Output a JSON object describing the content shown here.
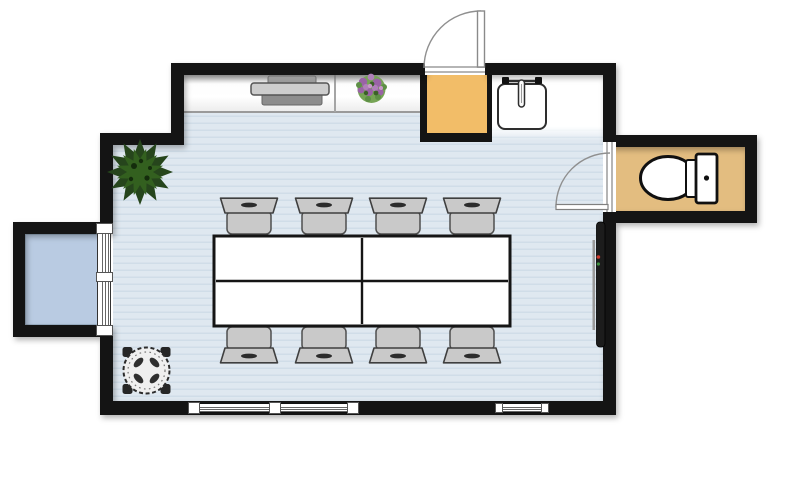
{
  "view": {
    "kind": "2d-floor-plan",
    "visible_text": [],
    "rooms": [
      {
        "name": "meeting-room",
        "floor_color": "#dfe8f0",
        "floor_pattern": "horizontal-stripes"
      },
      {
        "name": "balcony-bay",
        "floor_color": "#b9cbe2"
      },
      {
        "name": "closet",
        "floor_color": "#f2bd68"
      },
      {
        "name": "kitchenette-nook",
        "floor_color": "#ffffff"
      },
      {
        "name": "bathroom",
        "floor_color": "#e3bd80"
      }
    ],
    "furniture": [
      {
        "name": "conference-table",
        "count": 1,
        "segments": 4,
        "color": "#ffffff"
      },
      {
        "name": "chair",
        "count": 8,
        "arrangement": "4 top / 4 bottom",
        "color": "#c9c9c9"
      },
      {
        "name": "bistro-table",
        "count": 1,
        "shape": "round-dashed"
      },
      {
        "name": "large-plant",
        "count": 1,
        "color": "#26451c"
      },
      {
        "name": "flower-pot",
        "count": 1,
        "colors": [
          "#9a63a6",
          "#76a455"
        ]
      },
      {
        "name": "printer",
        "count": 1,
        "color": "#8d8d8d"
      },
      {
        "name": "wall-tv",
        "count": 1,
        "color": "#1c1c1c"
      },
      {
        "name": "sink",
        "count": 1
      },
      {
        "name": "toilet",
        "count": 1
      }
    ],
    "openings": [
      {
        "name": "entry-door",
        "wall": "top",
        "swing": "out"
      },
      {
        "name": "bathroom-door",
        "wall": "right",
        "swing": "in"
      },
      {
        "name": "double-window",
        "wall": "bottom"
      },
      {
        "name": "single-window",
        "wall": "bottom"
      },
      {
        "name": "bay-window",
        "wall": "left",
        "panes": 2
      }
    ]
  },
  "colors": {
    "wall": "#141414",
    "floor": "#dfe8f0",
    "stripe": "#d0dde8",
    "bay": "#b9cbe2",
    "closet": "#f2bd68",
    "bath": "#e3bd80",
    "chair": "#c9c9c9",
    "table": "#ffffff",
    "tv": "#1c1c1c",
    "plant": "#26451c",
    "plant2": "#33601f",
    "flower": "#9a63a6",
    "flower2": "#76a455"
  }
}
